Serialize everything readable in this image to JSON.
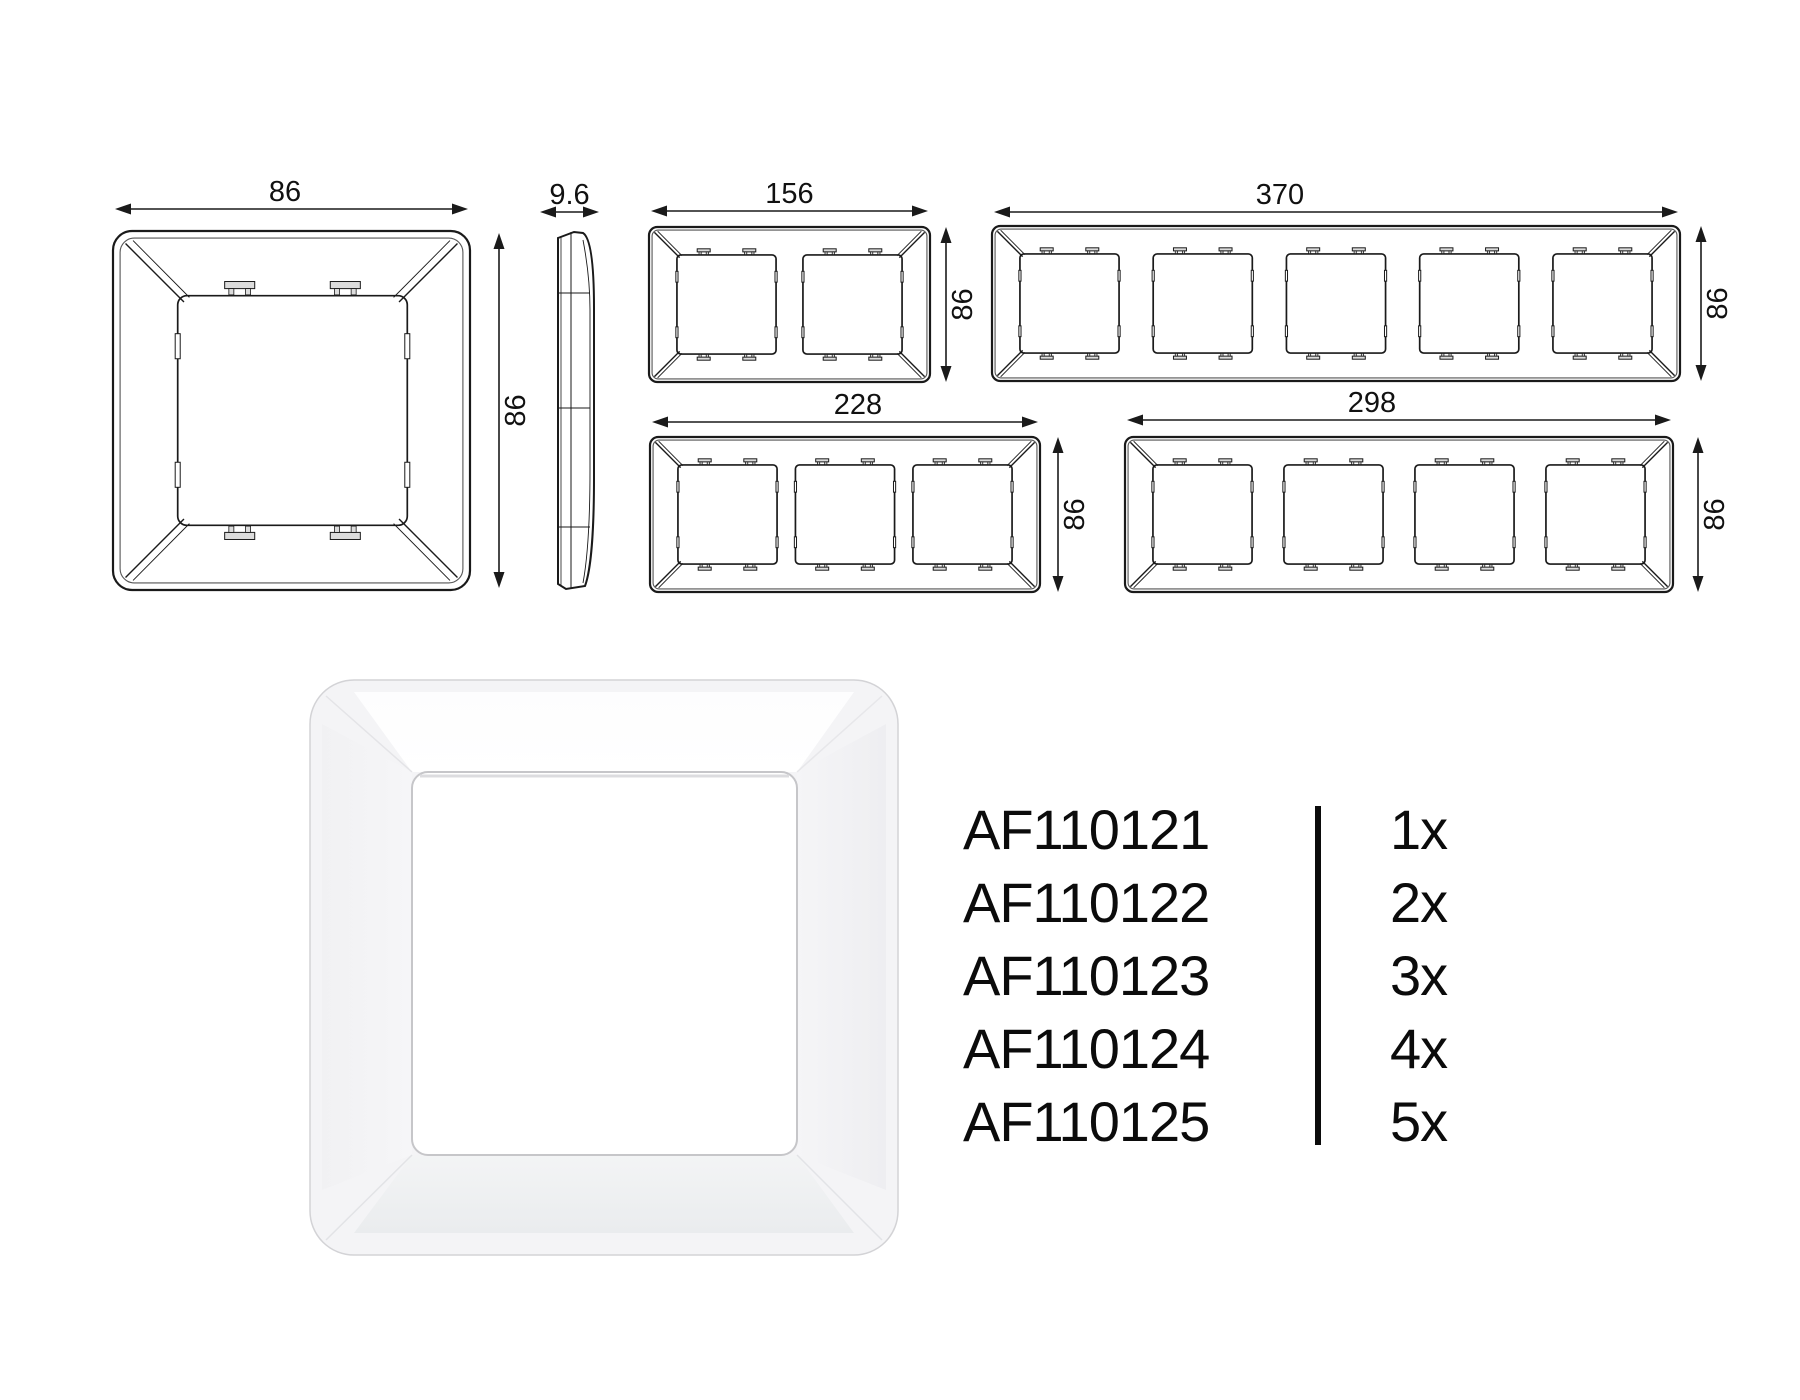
{
  "page": {
    "background": "#ffffff",
    "line_color": "#1a1a1a",
    "text_color": "#0b0b0b"
  },
  "drawings": {
    "single_frame_back": {
      "width_label": "86",
      "height_label": "86"
    },
    "side_profile": {
      "depth_label": "9.6"
    },
    "frame_2gang": {
      "width_label": "156",
      "height_label": "86"
    },
    "frame_5gang": {
      "width_label": "370",
      "height_label": "86"
    },
    "frame_3gang": {
      "width_label": "228",
      "height_label": "86"
    },
    "frame_4gang": {
      "width_label": "298",
      "height_label": "86"
    }
  },
  "products": [
    {
      "code": "AF110121",
      "quantity": "1x"
    },
    {
      "code": "AF110122",
      "quantity": "2x"
    },
    {
      "code": "AF110123",
      "quantity": "3x"
    },
    {
      "code": "AF110124",
      "quantity": "4x"
    },
    {
      "code": "AF110125",
      "quantity": "5x"
    }
  ]
}
